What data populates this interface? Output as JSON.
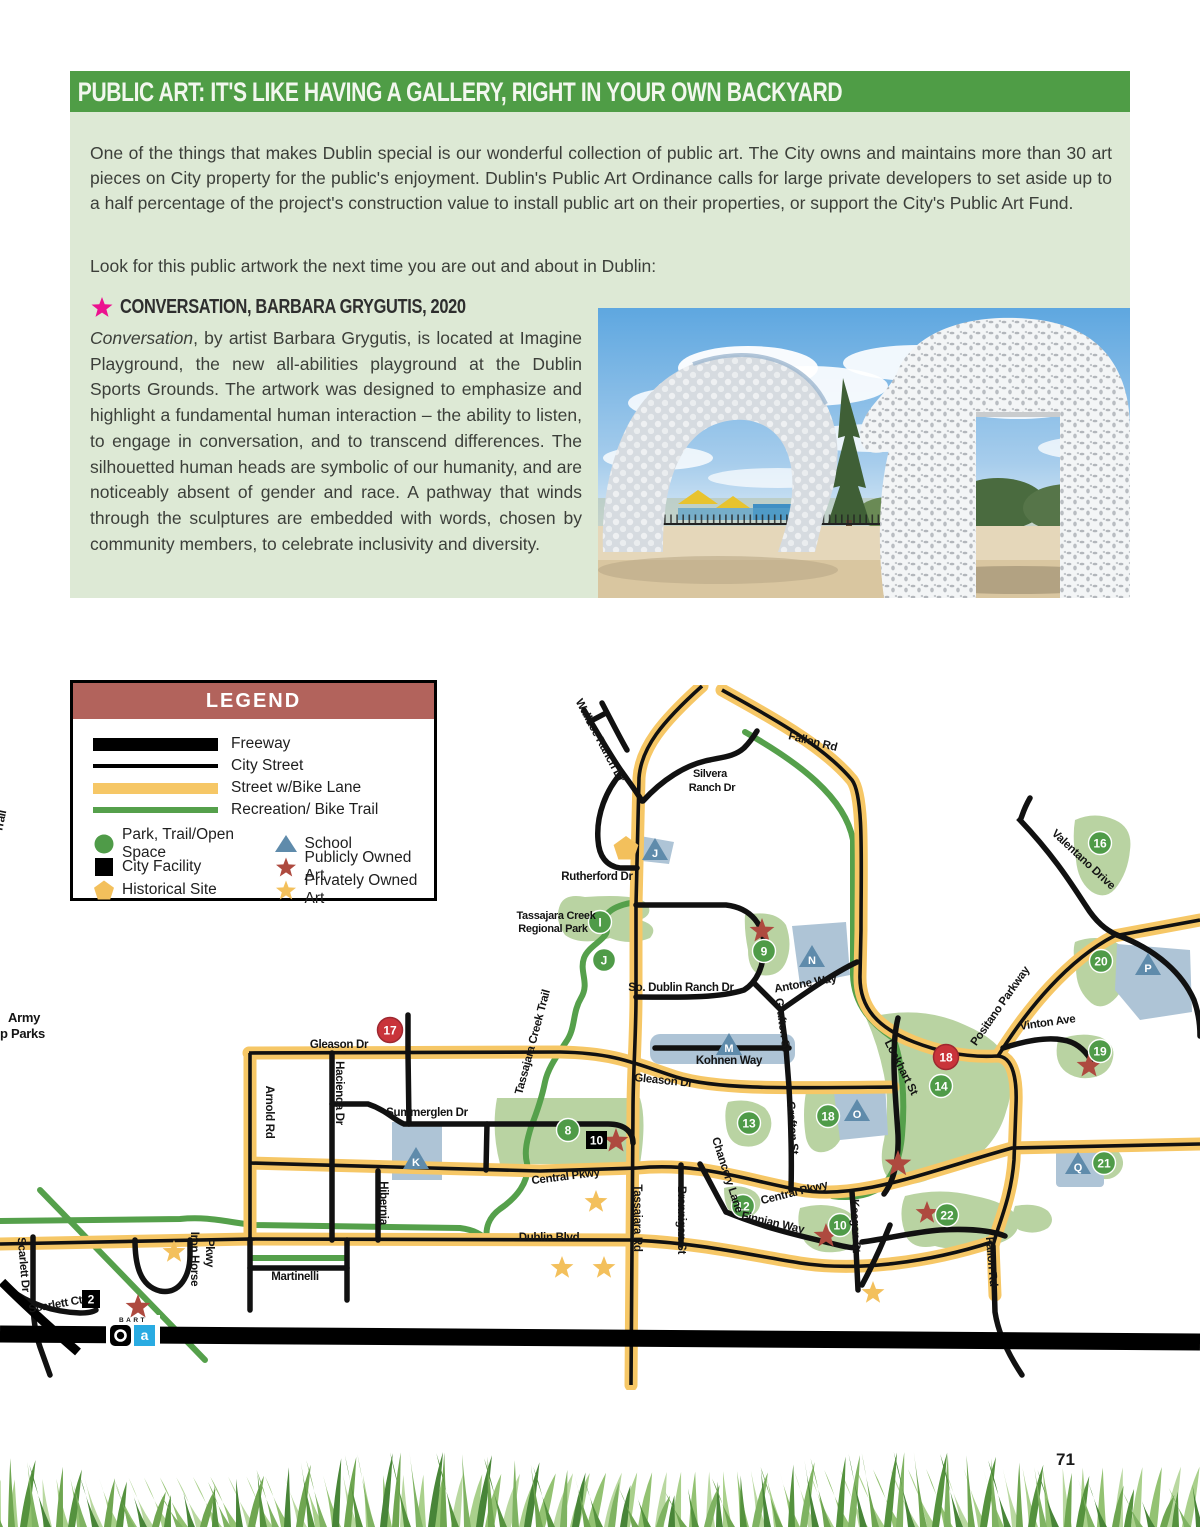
{
  "page": {
    "number": "71"
  },
  "header": {
    "title": "PUBLIC ART: IT'S LIKE HAVING A GALLERY, RIGHT IN YOUR OWN BACKYARD"
  },
  "intro": {
    "p1": "One of the things that makes Dublin special is our wonderful collection of public art. The City owns and maintains more than 30 art pieces on City property for the public's enjoyment. Dublin's Public Art Ordinance calls for large private developers to set aside up to a half percentage of the project's construction value to install public art on their properties, or support the City's Public Art Fund.",
    "p2": "Look for this public artwork the next time you are out and about in Dublin:"
  },
  "artwork": {
    "title": "CONVERSATION, BARBARA GRYGUTIS, 2020",
    "lead": "Conversation",
    "body": ", by artist Barbara Grygutis, is located at Imagine Playground, the new all-abilities playground at the Dublin Sports Grounds. The artwork was designed to emphasize and highlight a fundamental human interaction – the ability to listen, to engage in conversation, and to transcend differences. The silhouetted human heads are symbolic of our humanity, and are noticeably absent of gender and race. A pathway that winds through the sculptures are embedded with words, chosen by community members, to celebrate inclusivity and diversity."
  },
  "legend": {
    "title": "LEGEND",
    "lines": [
      {
        "label": "Freeway"
      },
      {
        "label": "City Street"
      },
      {
        "label": "Street w/Bike Lane"
      },
      {
        "label": "Recreation/ Bike Trail"
      }
    ],
    "points_left": [
      {
        "label": "Park, Trail/Open Space"
      },
      {
        "label": "City Facility"
      },
      {
        "label": "Historical Site"
      }
    ],
    "points_right": [
      {
        "label": "School"
      },
      {
        "label": "Publicly Owned Art"
      },
      {
        "label": "Privately Owned Art"
      }
    ]
  },
  "map": {
    "streets": {
      "fallon_rd": "Fallon Rd",
      "wallace_ranch_dr": "Wallace Ranch Dr",
      "silvera_1": "Silvera",
      "silvera_2": "Ranch Dr",
      "rutherford_dr": "Rutherford Dr",
      "tass_park_1": "Tassajara Creek",
      "tass_park_2": "Regional Park",
      "tass_trail": "Tassajara Creek Trail",
      "so_dublin_ranch_dr": "So. Dublin Ranch Dr",
      "antone_way": "Antone Way",
      "grafton_st": "Grafton St",
      "kohnen_way": "Kohnen Way",
      "gleason_dr": "Gleason Dr",
      "lockhart_st": "Lockhart St",
      "positano_parkway": "Positano Parkway",
      "valentano_drive": "Valentano Drive",
      "vinton_ave": "Vinton Ave",
      "arnold_rd": "Arnold Rd",
      "hacienda_dr": "Hacienda Dr",
      "summerglen_dr": "Summerglen Dr",
      "hibernia": "Hibernia",
      "central_pkwy": "Central Pkwy",
      "tassajara_rd": "Tassajara Rd",
      "brannigan_st": "Brannigan St",
      "chancery_lane": "Chancery Lane",
      "finnian_way": "Finnian Way",
      "keegan_st": "Keegan St",
      "dublin_blvd": "Dublin Blvd",
      "martinelli": "Martinelli",
      "iron_horse_1": "Iron Horse",
      "iron_horse_2": "Pkwy",
      "scarlett_dr": "Scarlett Dr",
      "scarlett_ct": "Scarlett Ct"
    },
    "partials": {
      "trail": "Trail",
      "army": "Army",
      "parks": "p Parks",
      "bart": "BART",
      "bart_a": "a"
    },
    "markers": {
      "n2": "2",
      "n8": "8",
      "n9": "9",
      "n10": "10",
      "n12": "12",
      "n13": "13",
      "n14": "14",
      "n16": "16",
      "n17": "17",
      "n18": "18",
      "n19": "19",
      "n20": "20",
      "n21": "21",
      "n22": "22",
      "li": "I",
      "lj": "J",
      "lk": "K",
      "lm": "M",
      "ln": "N",
      "lo": "O",
      "lp": "P",
      "lq": "Q"
    }
  },
  "colors": {
    "header_green": "#4f9d46",
    "panel_green": "#dde9d5",
    "legend_red": "#b2635c",
    "road_yellow": "#f6c766",
    "trail_green": "#55a04b",
    "park_green": "#b9d3a2",
    "school_blue": "#aec4d6",
    "school_triangle": "#5f8bab",
    "marker_green": "#4f9b48",
    "marker_red": "#c9343a",
    "public_art_star": "#ae4a3f",
    "private_art_star": "#f3c05c",
    "title_star_pink": "#ec118f"
  }
}
